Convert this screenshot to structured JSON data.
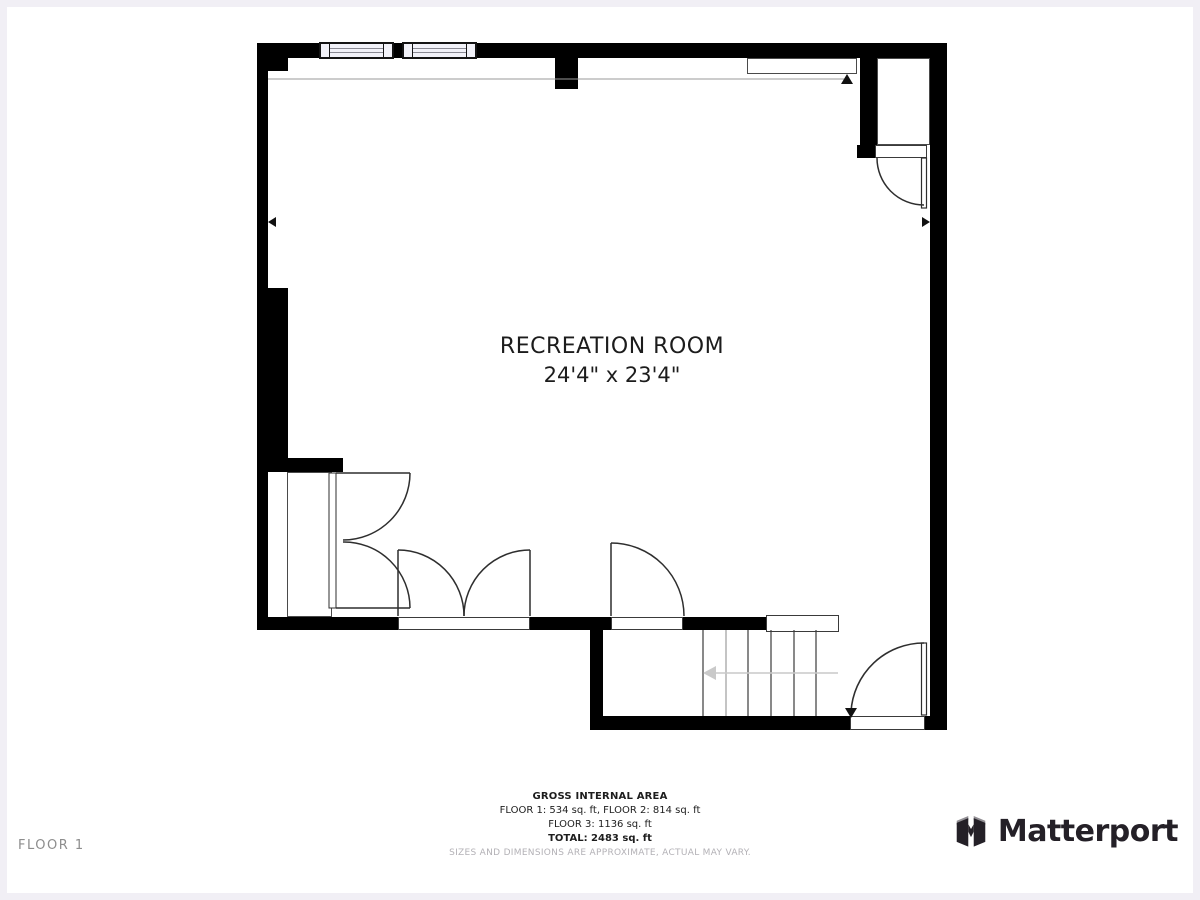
{
  "plan": {
    "room": {
      "name": "RECREATION ROOM",
      "dimensions": "24'4\" x 23'4\""
    },
    "floor_label": "FLOOR 1"
  },
  "footer": {
    "title": "GROSS INTERNAL AREA",
    "area_line_1": "FLOOR 1: 534 sq. ft, FLOOR 2: 814 sq. ft",
    "area_line_2": "FLOOR 3: 1136 sq. ft",
    "total_line": "TOTAL: 2483 sq. ft",
    "disclaimer": "SIZES AND DIMENSIONS ARE APPROXIMATE, ACTUAL MAY VARY."
  },
  "brand": {
    "name": "Matterport"
  },
  "colors": {
    "wall": "#000000",
    "window_fill": "#f2f2f9",
    "door_line": "#2e2e2e",
    "stair_arrow": "#c9c9c9",
    "page_frame": "#f1eff5",
    "muted_text": "#b3b1b6",
    "logo_dark": "#242027",
    "logo_gray": "#928f94"
  }
}
